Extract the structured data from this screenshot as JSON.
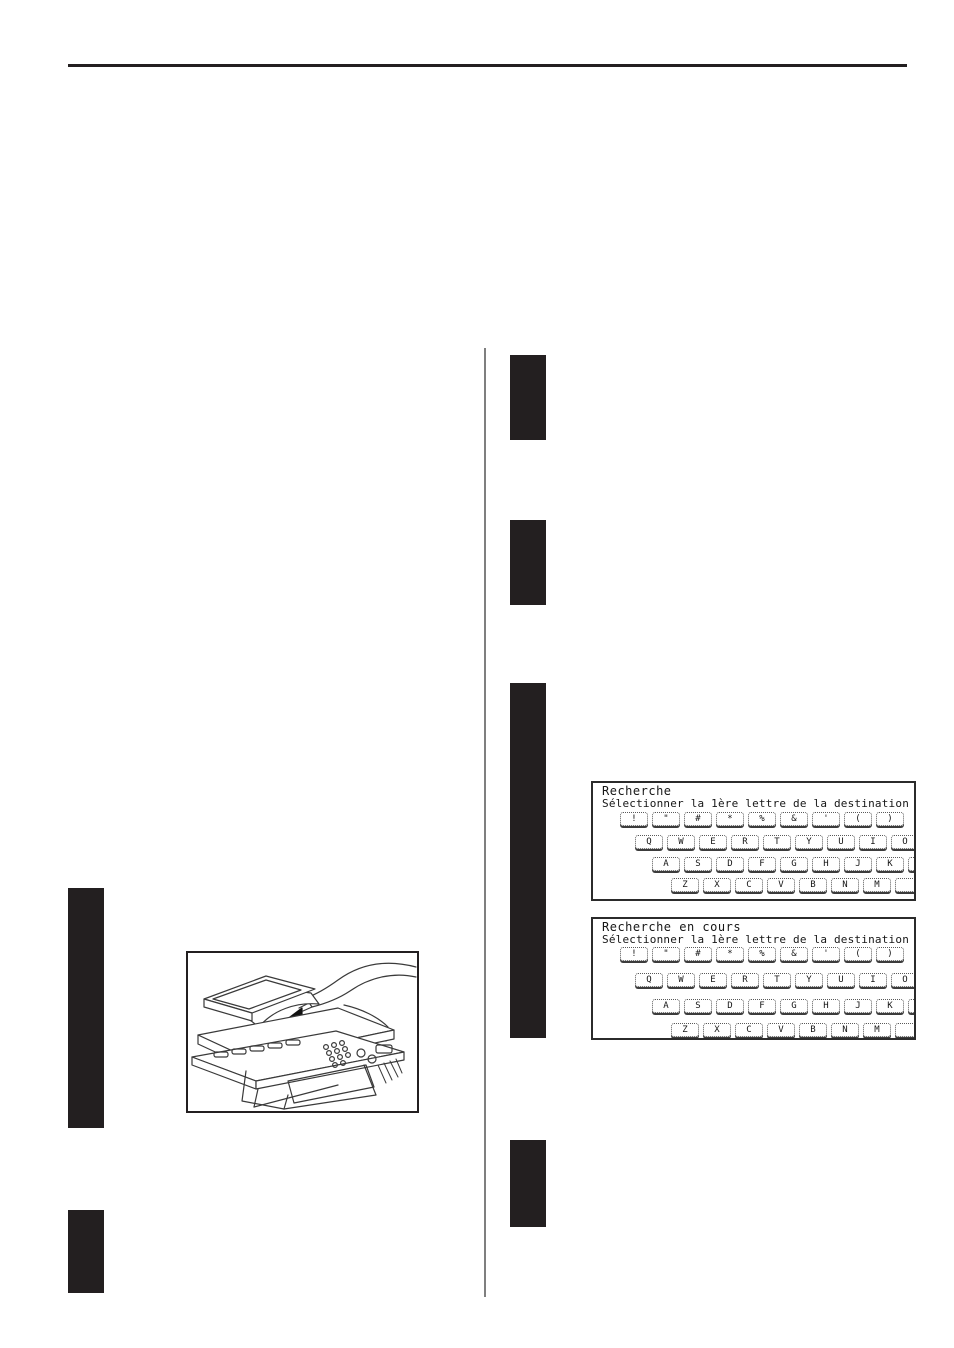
{
  "page": {
    "background": "#ffffff"
  },
  "decor": {
    "rule_color": "#231f20",
    "divider_color": "#7f7f7f",
    "redaction_bar_color": "#231f20"
  },
  "figure": {
    "description_icon": "copier-with-hand-inserting-document"
  },
  "screens": [
    {
      "title": "Recherche",
      "subtitle": "Sélectionner la 1ère lettre de la destination",
      "rows": [
        [
          "!",
          "\"",
          "#",
          "*",
          "%",
          "&",
          "'",
          "(",
          ")"
        ],
        [
          "Q",
          "W",
          "E",
          "R",
          "T",
          "Y",
          "U",
          "I",
          "O"
        ],
        [
          "A",
          "S",
          "D",
          "F",
          "G",
          "H",
          "J",
          "K",
          ""
        ],
        [
          "Z",
          "X",
          "C",
          "V",
          "B",
          "N",
          "M",
          ""
        ]
      ]
    },
    {
      "title": "Recherche en cours",
      "subtitle": "Sélectionner la 1ère lettre de la destination",
      "rows": [
        [
          "!",
          "\"",
          "#",
          "*",
          "%",
          "&",
          "'",
          "(",
          ")"
        ],
        [
          "Q",
          "W",
          "E",
          "R",
          "T",
          "Y",
          "U",
          "I",
          "O"
        ],
        [
          "A",
          "S",
          "D",
          "F",
          "G",
          "H",
          "J",
          "K",
          ""
        ],
        [
          "Z",
          "X",
          "C",
          "V",
          "B",
          "N",
          "M",
          ""
        ]
      ]
    }
  ]
}
